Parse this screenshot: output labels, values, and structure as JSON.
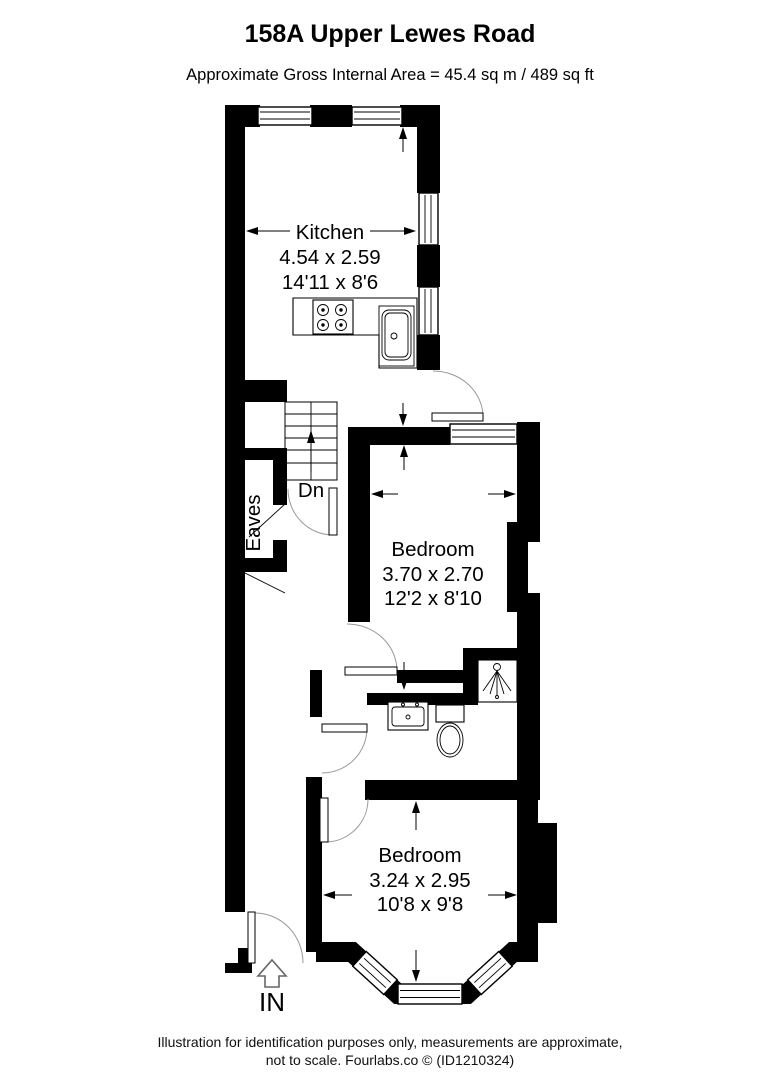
{
  "header": {
    "title": "158A Upper Lewes Road",
    "subtitle": "Approximate Gross Internal Area = 45.4 sq m / 489 sq ft"
  },
  "rooms": {
    "kitchen": {
      "name": "Kitchen",
      "metric": "4.54 x 2.59",
      "imperial": "14'11 x 8'6"
    },
    "bedroom1": {
      "name": "Bedroom",
      "metric": "3.70 x 2.70",
      "imperial": "12'2 x 8'10"
    },
    "bedroom2": {
      "name": "Bedroom",
      "metric": "3.24 x 2.95",
      "imperial": "10'8 x 9'8"
    }
  },
  "labels": {
    "stairs_down": "Dn",
    "eaves": "Eaves",
    "entrance": "IN"
  },
  "footer": {
    "line1": "Illustration for identification purposes only, measurements are approximate,",
    "line2": "not to scale. Fourlabs.co © (ID1210324)"
  },
  "colors": {
    "wall": "#000000",
    "background": "#ffffff",
    "door_arc": "#999999"
  }
}
